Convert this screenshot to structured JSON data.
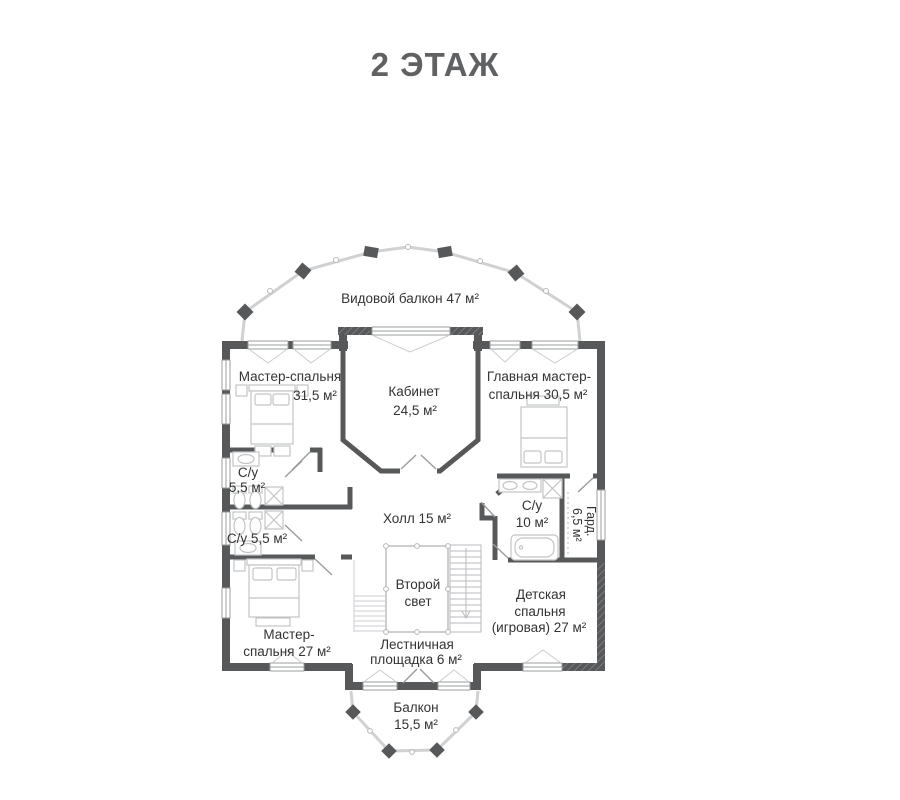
{
  "title": "2 ЭТАЖ",
  "floor_plan": {
    "colors": {
      "wall": "#57585a",
      "furniture_line": "#c3c4c6",
      "railing_line": "#d0d1d3",
      "door_line": "#9a9b9d",
      "label_text": "#333333",
      "title_text": "#606163"
    },
    "rooms": [
      {
        "id": "view-balcony",
        "lines": [
          "Видовой балкон 47 м²"
        ]
      },
      {
        "id": "master-bedroom-top",
        "lines": [
          "Мастер-спальня",
          "31,5 м²"
        ]
      },
      {
        "id": "study",
        "lines": [
          "Кабинет",
          "24,5 м²"
        ]
      },
      {
        "id": "main-master-bedroom",
        "lines": [
          "Главная мастер-",
          "спальня 30,5 м²"
        ]
      },
      {
        "id": "bathroom-upper",
        "lines": [
          "С/у",
          "5,5 м²"
        ]
      },
      {
        "id": "bathroom-lower",
        "lines": [
          "С/у 5,5 м²"
        ]
      },
      {
        "id": "hall",
        "lines": [
          "Холл 15 м²"
        ]
      },
      {
        "id": "bathroom-main",
        "lines": [
          "С/у",
          "10 м²"
        ]
      },
      {
        "id": "wardrobe",
        "lines": [
          "Гард.",
          "6,5 м²"
        ]
      },
      {
        "id": "second-light",
        "lines": [
          "Второй",
          "свет"
        ]
      },
      {
        "id": "master-bedroom-bottom",
        "lines": [
          "Мастер-",
          "спальня 27 м²"
        ]
      },
      {
        "id": "stair-landing",
        "lines": [
          "Лестничная",
          "площадка 6 м²"
        ]
      },
      {
        "id": "children-bedroom",
        "lines": [
          "Детская",
          "спальня",
          "(игровая) 27 м²"
        ]
      },
      {
        "id": "balcony-bottom",
        "lines": [
          "Балкон",
          "15,5 м²"
        ]
      }
    ]
  }
}
